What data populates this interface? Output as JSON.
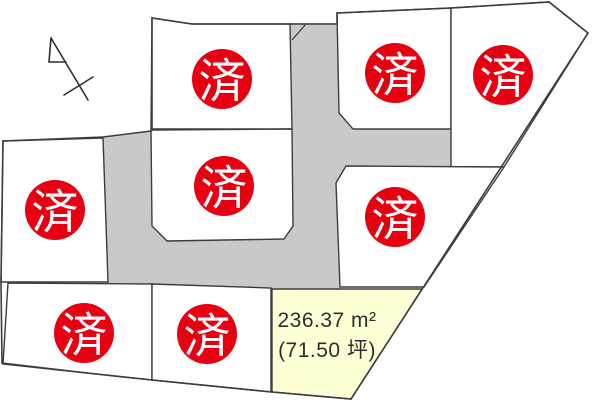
{
  "colors": {
    "background": "#ffffff",
    "road": "#c9c9cb",
    "lot_fill": "#ffffff",
    "available_fill": "#ffffd6",
    "stroke": "#3d3d3d",
    "sold_red": "#e60012",
    "sold_text": "#ffffff",
    "label_text": "#2e2e2e"
  },
  "sold_label": "済",
  "available_lot": {
    "area_m2": "236.37 m²",
    "area_tsubo": "(71.50 坪)"
  },
  "site_boundary": [
    [
      152,
      18
    ],
    [
      192,
      24
    ],
    [
      337,
      24
    ],
    [
      337,
      13
    ],
    [
      451,
      8
    ],
    [
      549,
      2
    ],
    [
      588,
      33
    ],
    [
      351,
      399
    ],
    [
      272,
      392
    ],
    [
      152,
      380
    ],
    [
      87,
      373
    ],
    [
      2,
      363
    ],
    [
      1,
      282
    ],
    [
      3,
      141
    ],
    [
      103,
      137
    ],
    [
      151,
      131
    ],
    [
      152,
      130
    ]
  ],
  "roads": [
    {
      "name": "road-vertical-center",
      "points": [
        [
          289,
          23
        ],
        [
          338,
          23
        ],
        [
          338,
          289
        ],
        [
          289,
          289
        ]
      ]
    },
    {
      "name": "road-horizontal-east",
      "points": [
        [
          337,
          128
        ],
        [
          452,
          128
        ],
        [
          452,
          169
        ],
        [
          337,
          169
        ]
      ]
    },
    {
      "name": "road-junction-east",
      "points": [
        [
          336,
          108
        ],
        [
          356,
          131
        ],
        [
          356,
          186
        ],
        [
          336,
          186
        ]
      ]
    },
    {
      "name": "road-horizontal-south",
      "points": [
        [
          107,
          225
        ],
        [
          340,
          225
        ],
        [
          340,
          289
        ],
        [
          107,
          289
        ]
      ]
    },
    {
      "name": "road-vertical-west",
      "points": [
        [
          103,
          137
        ],
        [
          151,
          131
        ],
        [
          152,
          286
        ],
        [
          107,
          286
        ]
      ]
    }
  ],
  "curb_line": [
    [
      306,
      24
    ],
    [
      292,
      40
    ]
  ],
  "lots": [
    {
      "name": "lot-1",
      "status": "sold",
      "points": [
        [
          152,
          18
        ],
        [
          192,
          24
        ],
        [
          290,
          24
        ],
        [
          292,
          129
        ],
        [
          151,
          129
        ]
      ],
      "marker": [
        222,
        79
      ]
    },
    {
      "name": "lot-2",
      "status": "sold",
      "points": [
        [
          151,
          130
        ],
        [
          292,
          129
        ],
        [
          293,
          226
        ],
        [
          284,
          239
        ],
        [
          167,
          241
        ],
        [
          152,
          226
        ]
      ],
      "marker": [
        224,
        186
      ]
    },
    {
      "name": "lot-3",
      "status": "sold",
      "points": [
        [
          3,
          141
        ],
        [
          103,
          138
        ],
        [
          108,
          282
        ],
        [
          1,
          282
        ]
      ],
      "marker": [
        55,
        210
      ]
    },
    {
      "name": "lot-4",
      "status": "sold",
      "points": [
        [
          337,
          13
        ],
        [
          451,
          8
        ],
        [
          451,
          129
        ],
        [
          353,
          129
        ],
        [
          339,
          113
        ]
      ],
      "marker": [
        395,
        73
      ]
    },
    {
      "name": "lot-5",
      "status": "sold",
      "points": [
        [
          451,
          8
        ],
        [
          549,
          2
        ],
        [
          588,
          33
        ],
        [
          504,
          167
        ],
        [
          451,
          167
        ]
      ],
      "marker": [
        503,
        75
      ]
    },
    {
      "name": "lot-6",
      "status": "sold",
      "points": [
        [
          336,
          183
        ],
        [
          346,
          166
        ],
        [
          504,
          167
        ],
        [
          424,
          287
        ],
        [
          340,
          287
        ]
      ],
      "marker": [
        395,
        217
      ]
    },
    {
      "name": "lot-7",
      "status": "sold",
      "points": [
        [
          8,
          283
        ],
        [
          152,
          284
        ],
        [
          152,
          380
        ],
        [
          87,
          373
        ],
        [
          3,
          364
        ]
      ],
      "marker": [
        84,
        333
      ]
    },
    {
      "name": "lot-8",
      "status": "sold",
      "points": [
        [
          152,
          284
        ],
        [
          271,
          288
        ],
        [
          271,
          392
        ],
        [
          152,
          380
        ]
      ],
      "marker": [
        207,
        334
      ]
    },
    {
      "name": "lot-9",
      "status": "available",
      "points": [
        [
          272,
          289
        ],
        [
          422,
          289
        ],
        [
          351,
          399
        ],
        [
          272,
          392
        ]
      ]
    }
  ],
  "sold_marker": {
    "radius": 30,
    "font_size": 47
  },
  "north_arrow": {
    "lines": [
      [
        [
          51,
          38
        ],
        [
          88,
          100
        ]
      ],
      [
        [
          51,
          38
        ],
        [
          49,
          62
        ]
      ],
      [
        [
          49,
          62
        ],
        [
          66,
          62
        ]
      ],
      [
        [
          64,
          95
        ],
        [
          93,
          77
        ]
      ]
    ]
  }
}
